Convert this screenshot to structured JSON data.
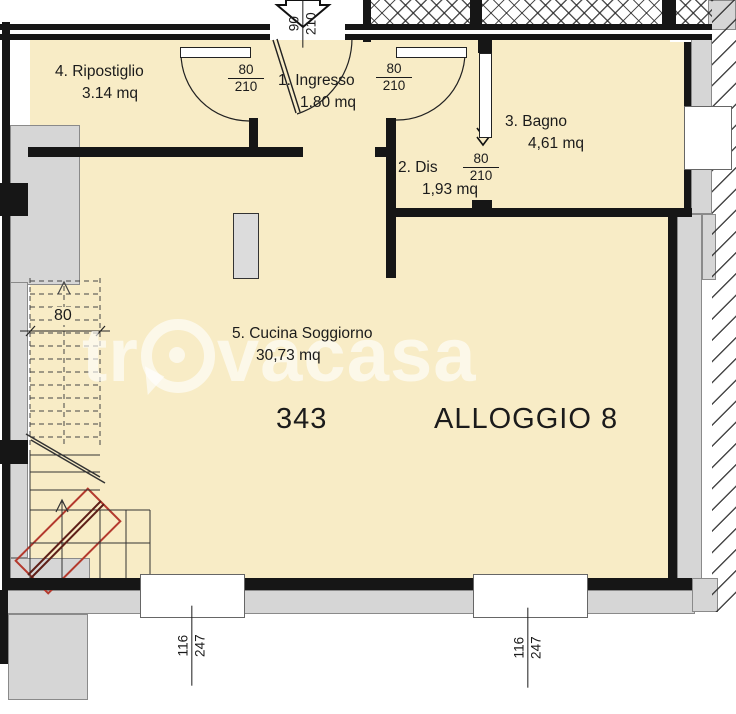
{
  "unit": {
    "code": "343",
    "name": "ALLOGGIO 8"
  },
  "watermark": {
    "left": "tr",
    "right": "vacasa"
  },
  "rooms": [
    {
      "id": "ripostiglio",
      "label": "4. Ripostiglio",
      "area": "3.14 mq"
    },
    {
      "id": "ingresso",
      "label": "1. Ingresso",
      "area": "1.80 mq"
    },
    {
      "id": "dis",
      "label": "2. Dis",
      "area": "1,93 mq"
    },
    {
      "id": "bagno",
      "label": "3. Bagno",
      "area": "4,61 mq"
    },
    {
      "id": "cucina",
      "label": "5. Cucina Soggiorno",
      "area": "30,73 mq"
    }
  ],
  "dims": {
    "entrance_door": {
      "num": "90",
      "den": "210"
    },
    "door_ripostiglio": {
      "num": "80",
      "den": "210"
    },
    "door_ingresso": {
      "num": "80",
      "den": "210"
    },
    "door_bagno": {
      "num": "80",
      "den": "210"
    },
    "stairs_width": "80",
    "window_left": {
      "num": "116",
      "den": "247"
    },
    "window_right": {
      "num": "116",
      "den": "247"
    }
  },
  "colors": {
    "floor": "#F8ECC6",
    "wall_black": "#161616",
    "wall_grey": "#D6D6D6",
    "accent_red": "#B43A2E"
  }
}
